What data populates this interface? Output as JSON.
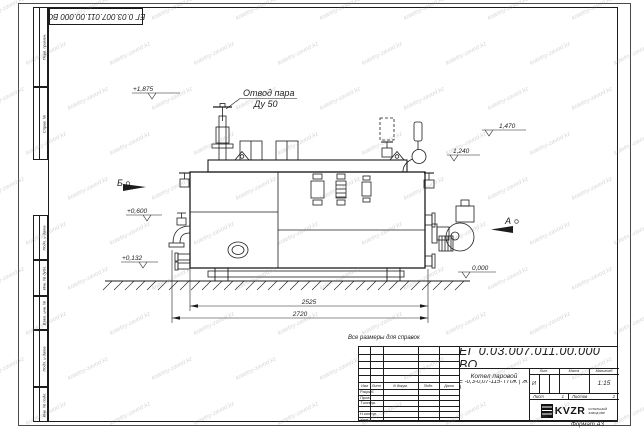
{
  "colors": {
    "line": "#1c1c1c",
    "watermark": "#7a8698",
    "paper": "#ffffff"
  },
  "watermark": {
    "text": "kotelny-zavod.kz"
  },
  "frame": {
    "top_designation": "ЕГ 0.03.007.011.00.000  ВО",
    "format_label": "Формат А3",
    "margin_labels": [
      "Перв. примен.",
      "Справ. №",
      "Подп. и дата",
      "Инв. № дубл.",
      "Взам. инв. №",
      "Подп. и дата",
      "Инв. № подл."
    ]
  },
  "drawing": {
    "note": "Все размеры для справок",
    "steam_outlet_label": "Отвод пара",
    "steam_outlet_size": "Ду 50",
    "view_a": "А",
    "view_b": "Б",
    "levels": [
      "+1,875",
      "+0,600",
      "+0,132",
      "1,470",
      "1,240",
      "0,000"
    ],
    "dimensions": [
      "2525",
      "2720"
    ]
  },
  "title_block": {
    "designation": "ЕГ 0.03.007.011.00.000  ВО",
    "product_name_line1": "Котел паровой",
    "product_name_line2": "Е -0,3-0,07-115- ГПЖ ( Ж )",
    "header_row": [
      "Изм",
      "Лист",
      "N докум.",
      "Подп.",
      "Дата"
    ],
    "row_labels": [
      "Разраб.",
      "Пров.",
      "Т.контр.",
      "Н.контр.",
      "Утв."
    ],
    "lit_header": "Лит.",
    "lit_value": "И",
    "mass_header": "Масса",
    "scale_header": "Масштаб",
    "scale_value": "1:15",
    "sheet_label": "Лист",
    "sheet_number": "1",
    "sheets_label": "Листов",
    "sheets_total": "2",
    "company_logo_text": "KVZR",
    "company_name_line1": "КОТЕЛЬНЫЙ",
    "company_name_line2": "ЗАВОД КВР"
  }
}
